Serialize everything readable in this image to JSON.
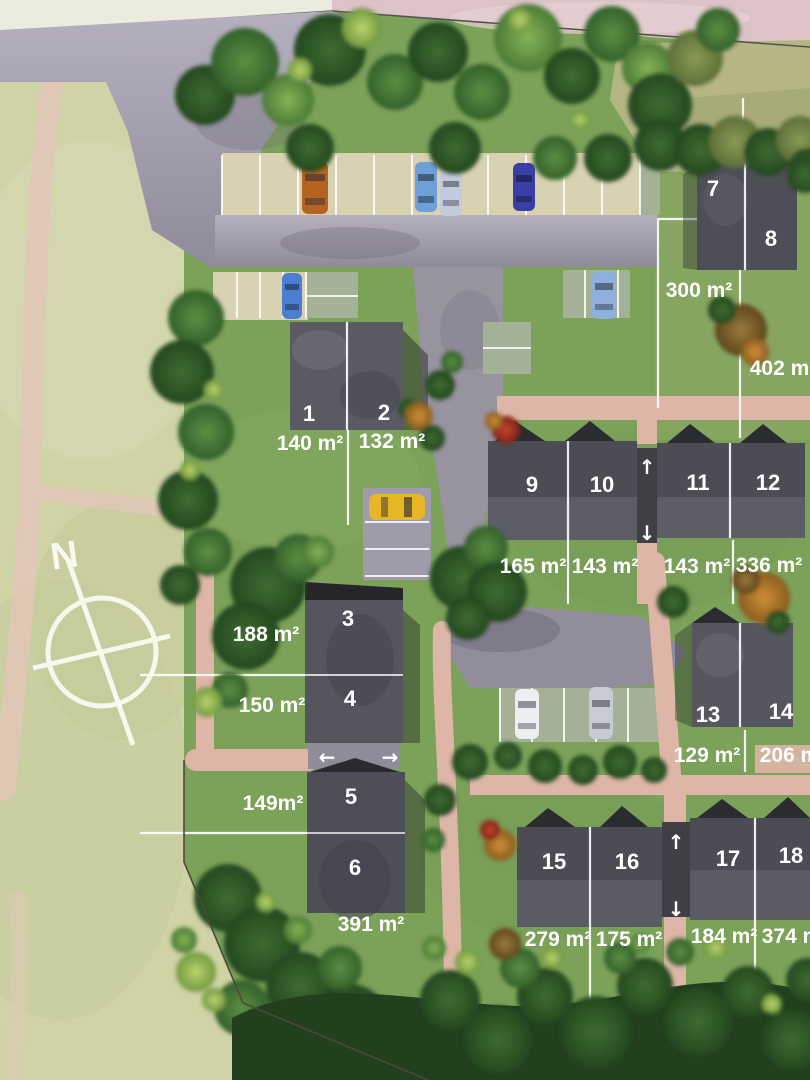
{
  "map": {
    "compass": {
      "label": "N"
    },
    "plots": [
      {
        "number": "1",
        "area": "140 m²"
      },
      {
        "number": "2",
        "area": "132 m²"
      },
      {
        "number": "3",
        "area": "188 m²"
      },
      {
        "number": "4",
        "area": "150 m²"
      },
      {
        "number": "5",
        "area": "149m²"
      },
      {
        "number": "6",
        "area": "391 m²"
      },
      {
        "number": "7",
        "area": "300 m²"
      },
      {
        "number": "8",
        "area": "402 m²"
      },
      {
        "number": "9",
        "area": "165 m²"
      },
      {
        "number": "10",
        "area": "143 m²"
      },
      {
        "number": "11",
        "area": "143 m²"
      },
      {
        "number": "12",
        "area": "336 m²"
      },
      {
        "number": "13",
        "area": "129 m²"
      },
      {
        "number": "14",
        "area": "206 m²"
      },
      {
        "number": "15",
        "area": "279 m²"
      },
      {
        "number": "16",
        "area": "175 m²"
      },
      {
        "number": "17",
        "area": "184 m²"
      },
      {
        "number": "18",
        "area": "374 m²"
      }
    ],
    "arrows": {
      "up": "↑",
      "down": "↓",
      "left": "←",
      "right": "→"
    },
    "colors": {
      "field": "#cfd3a6",
      "grass": "#7ca25a",
      "road": "#a29eac",
      "parking_beige": "#d8d2b2",
      "parking_green": "#a3b196",
      "path_pink": "#ddb6a7",
      "roof": "#50505a",
      "label": "#ffffff"
    },
    "cars": [
      {
        "name": "orange-car",
        "hex": "#b5641f"
      },
      {
        "name": "light-blue-car",
        "hex": "#6f9fd8"
      },
      {
        "name": "silver-car",
        "hex": "#c3cade"
      },
      {
        "name": "dark-blue-car",
        "hex": "#3a3fa8"
      },
      {
        "name": "blue-car",
        "hex": "#4a7ed0"
      },
      {
        "name": "steel-blue-car",
        "hex": "#8fb0dc"
      },
      {
        "name": "yellow-car",
        "hex": "#e7b627"
      },
      {
        "name": "white-car",
        "hex": "#eceff1"
      },
      {
        "name": "grey-car",
        "hex": "#c7cbd3"
      }
    ]
  }
}
